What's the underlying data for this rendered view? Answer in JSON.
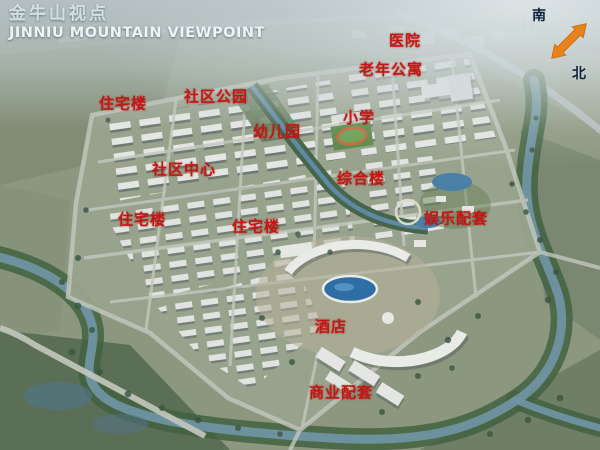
{
  "title": {
    "zh": "金牛山视点",
    "en": "JINNIU MOUNTAIN VIEWPOINT"
  },
  "compass": {
    "south": "南",
    "north": "北"
  },
  "map_labels": [
    {
      "id": "hospital",
      "text": "医院"
    },
    {
      "id": "senior-apartments",
      "text": "老年公寓"
    },
    {
      "id": "residential-1",
      "text": "住宅楼"
    },
    {
      "id": "community-park",
      "text": "社区公园"
    },
    {
      "id": "primary-school",
      "text": "小学"
    },
    {
      "id": "kindergarten",
      "text": "幼儿园"
    },
    {
      "id": "community-center",
      "text": "社区中心"
    },
    {
      "id": "complex-building",
      "text": "综合楼"
    },
    {
      "id": "residential-2",
      "text": "住宅楼"
    },
    {
      "id": "residential-3",
      "text": "住宅楼"
    },
    {
      "id": "entertainment-amenities",
      "text": "娱乐配套"
    },
    {
      "id": "hotel",
      "text": "酒店"
    },
    {
      "id": "commercial-amenities",
      "text": "商业配套"
    }
  ],
  "colors": {
    "label_red": "#c21713",
    "arrow_orange": "#e8831c",
    "compass_text": "#0d1f3c",
    "pool_blue": "#2e6ea5",
    "river_blue": "#6f93a2"
  }
}
